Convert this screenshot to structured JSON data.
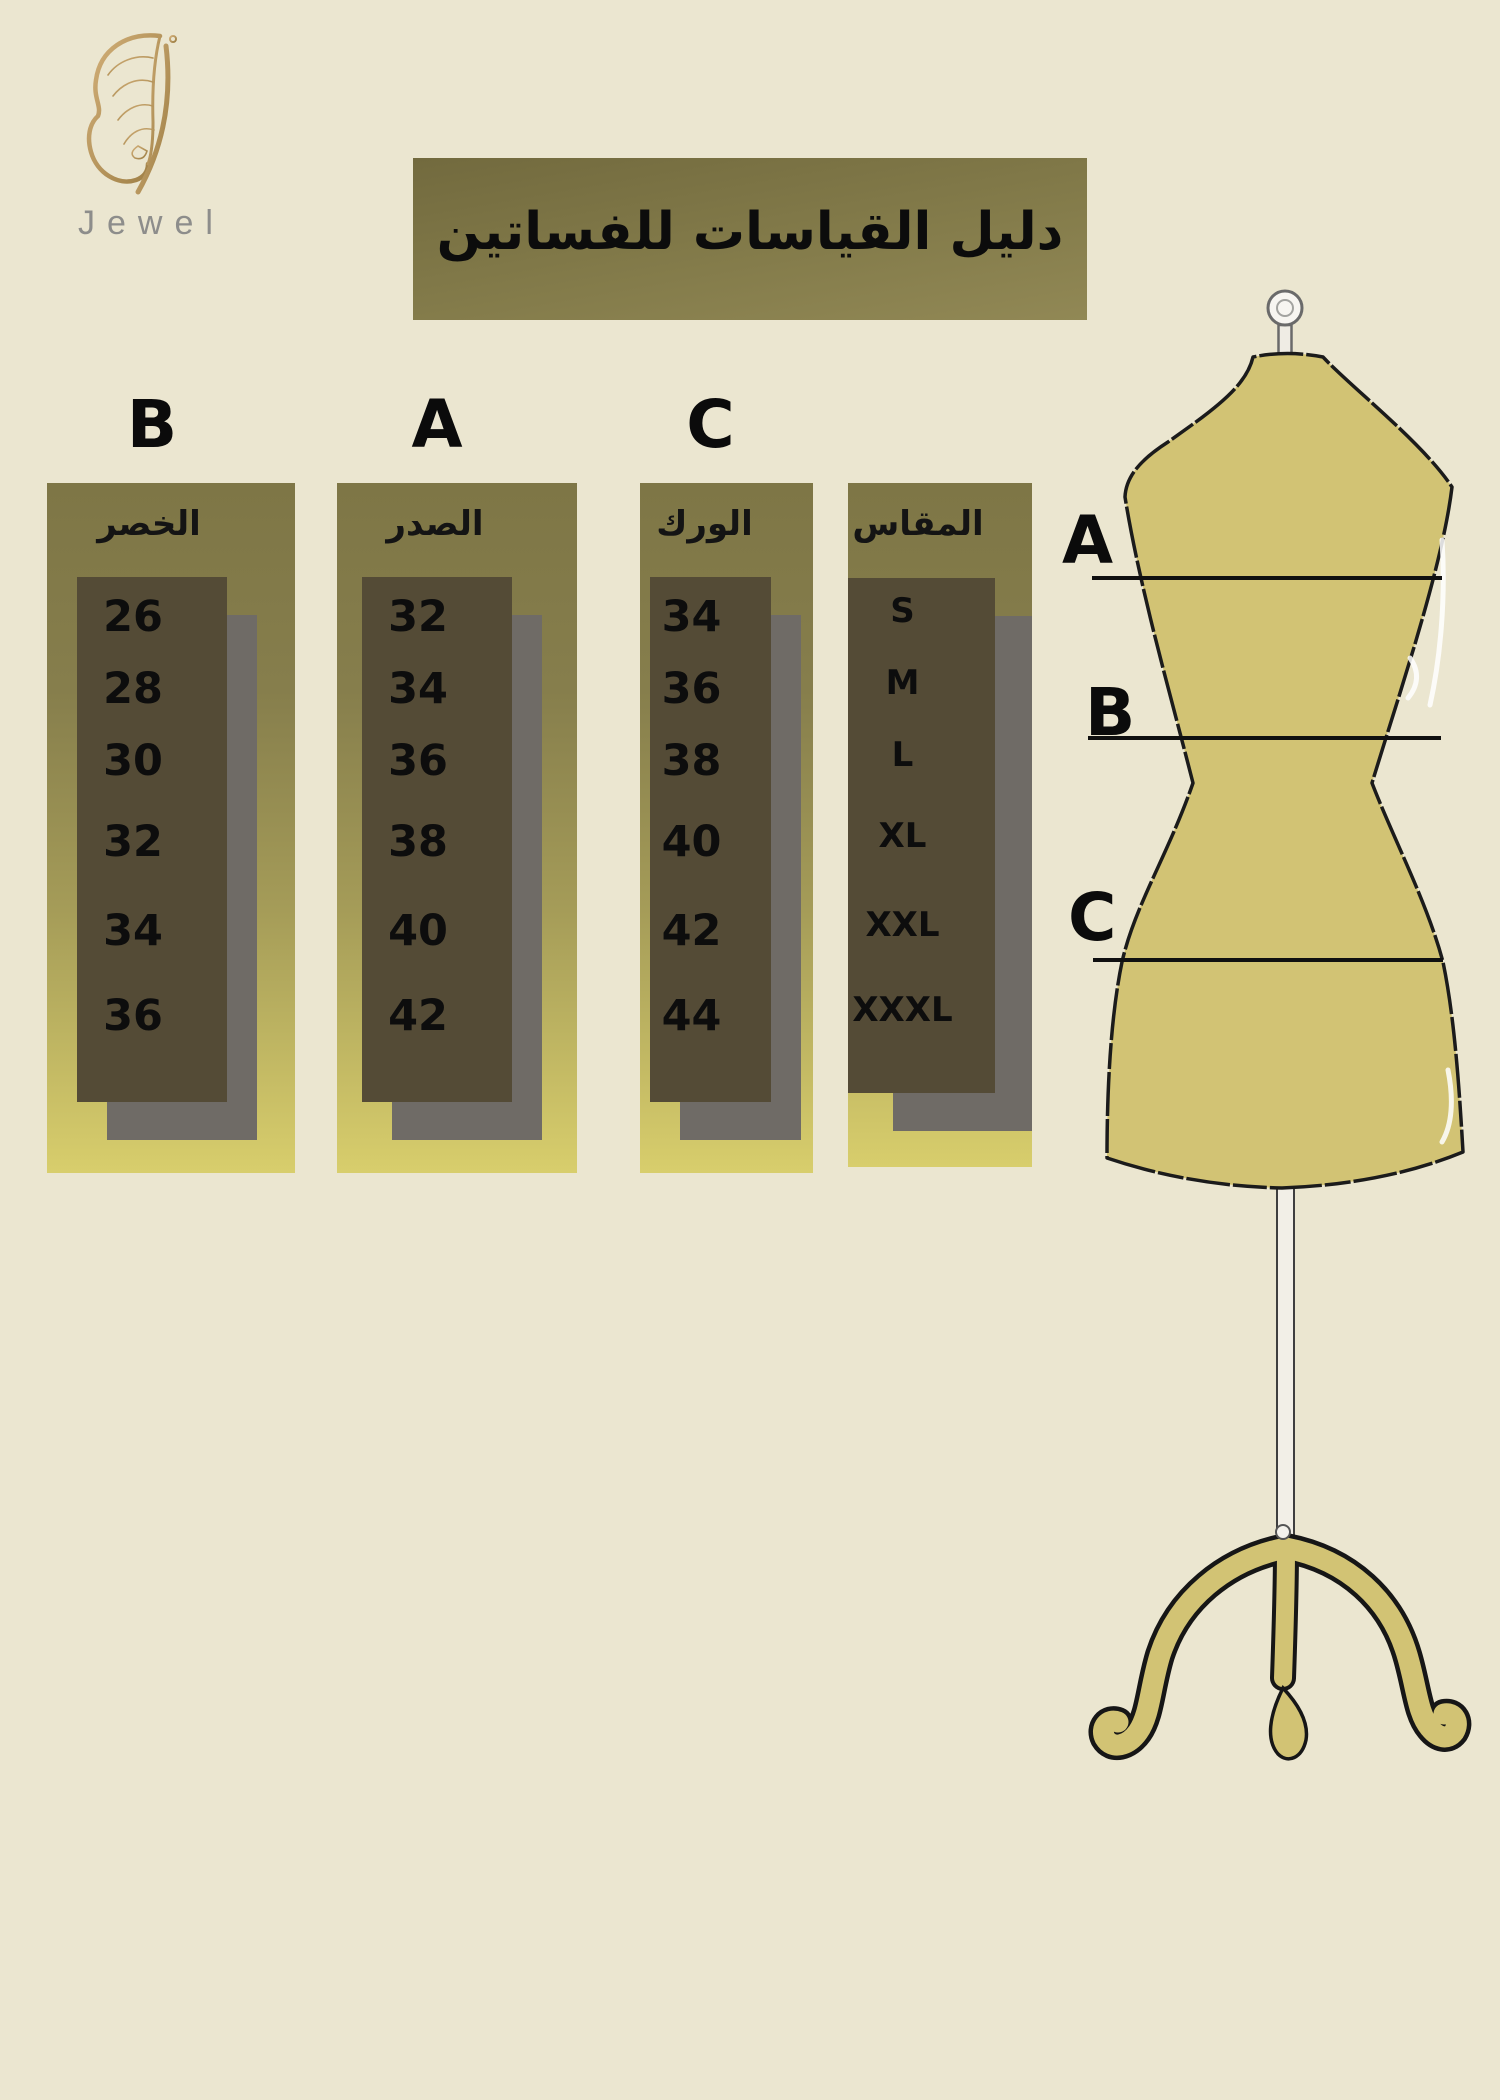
{
  "brand": {
    "name": "Jewel"
  },
  "title": {
    "text": "دليل القياسات للفساتين"
  },
  "size_table": {
    "columns": [
      {
        "letter": "B",
        "header": "الخصر",
        "values": [
          "26",
          "28",
          "30",
          "32",
          "34",
          "36"
        ]
      },
      {
        "letter": "A",
        "header": "الصدر",
        "values": [
          "32",
          "34",
          "36",
          "38",
          "40",
          "42"
        ]
      },
      {
        "letter": "C",
        "header": "الورك",
        "values": [
          "34",
          "36",
          "38",
          "40",
          "42",
          "44"
        ]
      },
      {
        "letter": "",
        "header": "المقاس",
        "values": [
          "S",
          "M",
          "L",
          "XL",
          "XXL",
          "XXXL"
        ]
      }
    ]
  },
  "mannequin": {
    "labels": [
      "A",
      "B",
      "C"
    ]
  },
  "colors": {
    "background": "#ebe6d0",
    "banner_olive": "#7c7445",
    "panel_top_olive": "#7e7646",
    "panel_bottom_yellow": "#d8ce6c",
    "cell_dark": "#544b36",
    "shadow_gray": "#6f6b66",
    "mannequin_khaki": "#d2c374",
    "logo_gold": "#c29c5e",
    "brand_text_gray": "#8d8d8b",
    "text_black": "#0d0d0d"
  }
}
